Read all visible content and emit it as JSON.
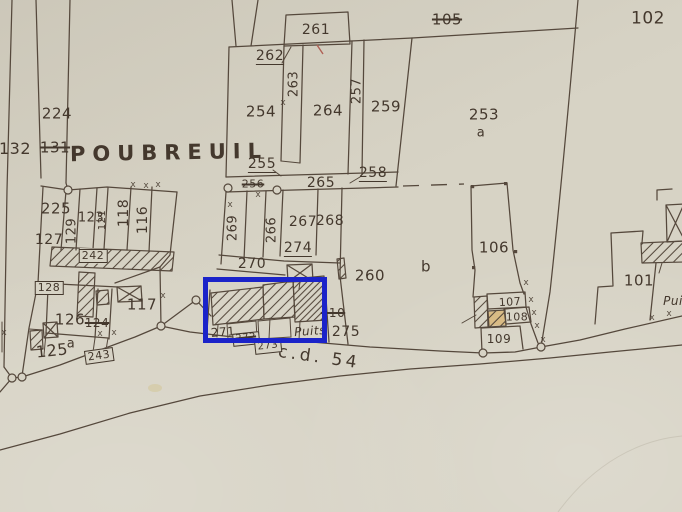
{
  "colors": {
    "paper": "#d7d3c5",
    "ink": "#55483c",
    "text": "#44382d",
    "highlight": "#1b23c9",
    "tan": "#d8a54e",
    "red": "#b06055",
    "crease": "#bdb8a9"
  },
  "place_name": "POUBREUIL",
  "road_name": "c.d. 54",
  "well_label": "Puits",
  "map_labels": [
    {
      "text": "POUBREUIL",
      "x": 169,
      "y": 153,
      "size": 21,
      "rot": -1,
      "style": "place"
    },
    {
      "text": "c.d. 54",
      "x": 319,
      "y": 358,
      "size": 17,
      "rot": 8,
      "style": "road"
    },
    {
      "text": "132",
      "x": 15,
      "y": 149,
      "size": 16,
      "style": ""
    },
    {
      "text": "224",
      "x": 57,
      "y": 114,
      "size": 15,
      "style": ""
    },
    {
      "text": "131",
      "x": 55,
      "y": 148,
      "size": 15,
      "style": "struck"
    },
    {
      "text": "225",
      "x": 56,
      "y": 209,
      "size": 15,
      "style": ""
    },
    {
      "text": "127",
      "x": 49,
      "y": 240,
      "size": 14,
      "style": ""
    },
    {
      "text": "129",
      "x": 72,
      "y": 231,
      "size": 13,
      "style": "vertical"
    },
    {
      "text": "123",
      "x": 91,
      "y": 218,
      "size": 13,
      "style": ""
    },
    {
      "text": "121",
      "x": 103,
      "y": 220,
      "size": 10,
      "style": "vertical"
    },
    {
      "text": "118",
      "x": 124,
      "y": 213,
      "size": 14,
      "style": "vertical"
    },
    {
      "text": "116",
      "x": 143,
      "y": 220,
      "size": 14,
      "style": "vertical"
    },
    {
      "text": "242",
      "x": 93,
      "y": 256,
      "size": 11,
      "style": "boxed"
    },
    {
      "text": "128",
      "x": 49,
      "y": 288,
      "size": 11,
      "style": "boxed"
    },
    {
      "text": "126",
      "x": 70,
      "y": 320,
      "size": 15,
      "style": ""
    },
    {
      "text": "124",
      "x": 97,
      "y": 323,
      "size": 12,
      "style": "struck"
    },
    {
      "text": "117",
      "x": 142,
      "y": 305,
      "size": 15,
      "style": ""
    },
    {
      "text": "125",
      "x": 52,
      "y": 351,
      "size": 16,
      "rot": -6,
      "style": ""
    },
    {
      "text": "a",
      "x": 71,
      "y": 344,
      "size": 13,
      "style": ""
    },
    {
      "text": "243",
      "x": 99,
      "y": 356,
      "size": 11,
      "rot": -8,
      "style": "boxed"
    },
    {
      "text": "261",
      "x": 316,
      "y": 30,
      "size": 14,
      "style": ""
    },
    {
      "text": "262",
      "x": 270,
      "y": 57,
      "size": 14,
      "style": "underlined"
    },
    {
      "text": "263",
      "x": 294,
      "y": 84,
      "size": 13,
      "style": "vertical"
    },
    {
      "text": "254",
      "x": 261,
      "y": 112,
      "size": 15,
      "style": ""
    },
    {
      "text": "264",
      "x": 328,
      "y": 111,
      "size": 15,
      "style": ""
    },
    {
      "text": "257",
      "x": 357,
      "y": 91,
      "size": 13,
      "style": "vertical"
    },
    {
      "text": "259",
      "x": 386,
      "y": 107,
      "size": 15,
      "style": ""
    },
    {
      "text": "105",
      "x": 447,
      "y": 20,
      "size": 15,
      "style": "struck"
    },
    {
      "text": "102",
      "x": 648,
      "y": 19,
      "size": 17,
      "style": ""
    },
    {
      "text": "253",
      "x": 484,
      "y": 115,
      "size": 15,
      "style": ""
    },
    {
      "text": "a",
      "x": 481,
      "y": 133,
      "size": 13,
      "style": ""
    },
    {
      "text": "255",
      "x": 262,
      "y": 165,
      "size": 14,
      "style": "underlined"
    },
    {
      "text": "256",
      "x": 253,
      "y": 184,
      "size": 11,
      "style": "struck"
    },
    {
      "text": "265",
      "x": 321,
      "y": 183,
      "size": 14,
      "style": ""
    },
    {
      "text": "258",
      "x": 373,
      "y": 174,
      "size": 14,
      "style": "underlined"
    },
    {
      "text": "269",
      "x": 233,
      "y": 228,
      "size": 13,
      "style": "vertical"
    },
    {
      "text": "266",
      "x": 272,
      "y": 230,
      "size": 13,
      "style": "vertical"
    },
    {
      "text": "267",
      "x": 303,
      "y": 222,
      "size": 14,
      "style": ""
    },
    {
      "text": "268",
      "x": 330,
      "y": 221,
      "size": 14,
      "style": ""
    },
    {
      "text": "274",
      "x": 298,
      "y": 249,
      "size": 14,
      "style": "underlined"
    },
    {
      "text": "270",
      "x": 252,
      "y": 264,
      "size": 14,
      "style": ""
    },
    {
      "text": "106",
      "x": 494,
      "y": 248,
      "size": 15,
      "style": ""
    },
    {
      "text": "b",
      "x": 426,
      "y": 267,
      "size": 15,
      "style": ""
    },
    {
      "text": "260",
      "x": 370,
      "y": 276,
      "size": 15,
      "style": ""
    },
    {
      "text": "110",
      "x": 333,
      "y": 313,
      "size": 12,
      "style": "struck"
    },
    {
      "text": "275",
      "x": 346,
      "y": 332,
      "size": 14,
      "style": ""
    },
    {
      "text": "271",
      "x": 223,
      "y": 332,
      "size": 12,
      "rot": -4,
      "style": ""
    },
    {
      "text": "272",
      "x": 246,
      "y": 339,
      "size": 10,
      "rot": -6,
      "style": "boxed struck"
    },
    {
      "text": "273",
      "x": 268,
      "y": 347,
      "size": 10,
      "rot": -6,
      "style": "boxed"
    },
    {
      "text": "Puits",
      "x": 310,
      "y": 331,
      "size": 12,
      "rot": -4,
      "style": "italic"
    },
    {
      "text": "101",
      "x": 639,
      "y": 281,
      "size": 15,
      "style": ""
    },
    {
      "text": "107",
      "x": 510,
      "y": 302,
      "size": 11,
      "rot": -3,
      "style": ""
    },
    {
      "text": "108",
      "x": 517,
      "y": 317,
      "size": 11,
      "style": ""
    },
    {
      "text": "109",
      "x": 499,
      "y": 339,
      "size": 12,
      "style": ""
    },
    {
      "text": "Puits",
      "x": 679,
      "y": 301,
      "size": 12,
      "style": "italic"
    }
  ],
  "boundary_marks": {
    "symbol": "x",
    "points": [
      [
        283,
        103
      ],
      [
        230,
        205
      ],
      [
        258,
        195
      ],
      [
        133,
        185
      ],
      [
        146,
        186
      ],
      [
        158,
        185
      ],
      [
        526,
        283
      ],
      [
        531,
        300
      ],
      [
        534,
        313
      ],
      [
        537,
        326
      ],
      [
        543,
        340
      ],
      [
        652,
        318
      ],
      [
        669,
        314
      ],
      [
        100,
        334
      ],
      [
        114,
        333
      ],
      [
        4,
        333
      ],
      [
        163,
        296
      ]
    ]
  }
}
